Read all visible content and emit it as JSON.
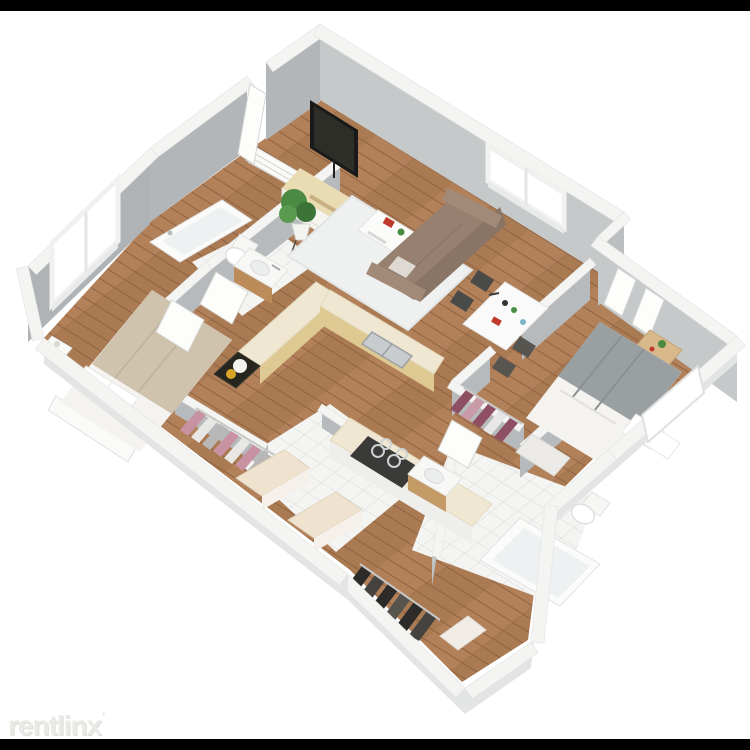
{
  "watermark": {
    "label": "rentlinx",
    "mark": "'"
  },
  "image": {
    "type": "3d-floorplan-render",
    "description": "Isometric 3D rendering of a two-bedroom, two-bathroom apartment floor plan viewed from above at an angle, on a white background with black letterbox bars at top and bottom, watermarked rentlinx."
  },
  "scene": {
    "rooms": [
      "living-room",
      "dining-area",
      "kitchen",
      "entry",
      "master-bedroom",
      "bathroom-1",
      "second-bedroom",
      "bathroom-2",
      "closet-a",
      "closet-b",
      "laundry-hall",
      "entry-wing-closet"
    ],
    "furniture": [
      "wall-mounted-tv",
      "media-console",
      "potted-plant",
      "area-rug",
      "coffee-table",
      "sofa",
      "dining-table",
      "dining-chairs",
      "l-shaped-counter",
      "double-sink",
      "gas-cooktop",
      "black-counter-with-kettle",
      "master-bed",
      "nightstand",
      "bathtub-1",
      "toilet-1",
      "vanity-sink-1",
      "guest-bed",
      "bed-bench",
      "bathtub-2",
      "toilet-2",
      "vanity-sink-2",
      "hanging-clothes-pink",
      "hanging-clothes-maroon",
      "hanging-clothes-dark",
      "dressers",
      "entry-shoe-rack",
      "open-doors",
      "windows"
    ]
  },
  "palette": {
    "background": "#ffffff",
    "letterbox_bar": "#000000",
    "wood_floor": "#aa7a53",
    "wall_face_shadow": "#b3b6b8",
    "wall_face_light": "#c6c9ca",
    "wall_top": "#f4f4f2",
    "tile_floor": "#f4f5f3",
    "tile_grid": "#d8dad8",
    "sofa_brown": "#97806f",
    "counter_cream": "#efe7d2",
    "counter_wood": "#dec993",
    "blanket_tan": "#cfc3ae",
    "blanket_gray": "#9aa0a2",
    "clothes_pink": "#c992a3",
    "clothes_maroon": "#8e4f63",
    "clothes_dark": "#2c2b29",
    "plant_green": "#4b8a42",
    "kettle_gold": "#d8a426",
    "watermark_gray": "#e4e4e1"
  }
}
